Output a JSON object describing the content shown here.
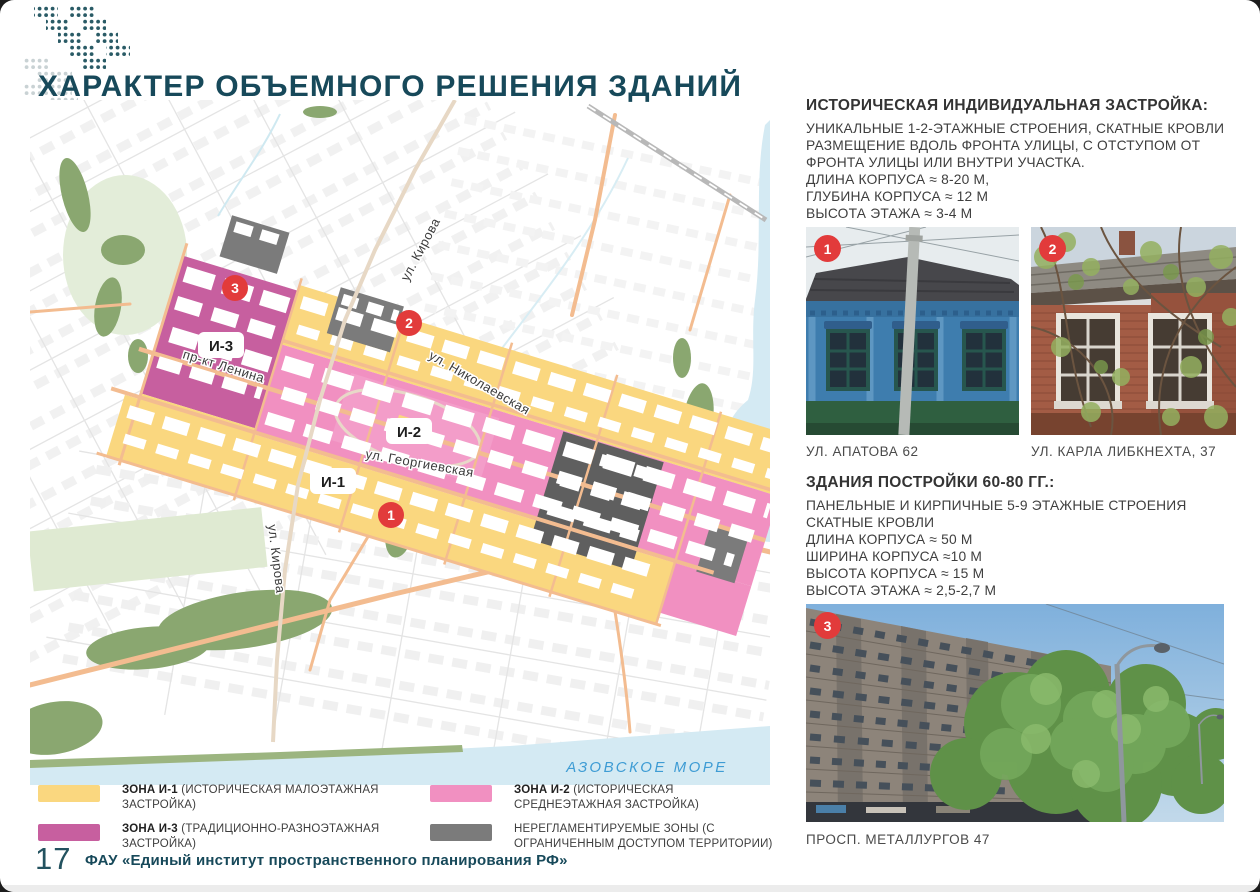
{
  "page": {
    "title": "ХАРАКТЕР ОБЪЕМНОГО РЕШЕНИЯ ЗДАНИЙ",
    "page_number": "17",
    "footer": "ФАУ «Единый институт пространственного планирования РФ»"
  },
  "colors": {
    "accent_teal": "#17495A",
    "zone_i1_yellow": "#FAD77F",
    "zone_i2_pink": "#F190C1",
    "zone_i3_magenta": "#C75F9F",
    "zone_gray": "#7B7B7B",
    "marker_red": "#E23B3B",
    "water": "#D4EAF3",
    "park_green": "#8AA770",
    "road_orange": "#F3BC90"
  },
  "map": {
    "sea_label": "АЗОВСКОЕ МОРЕ",
    "streets": [
      {
        "name": "ул. Кирова"
      },
      {
        "name": "ул. Николаевская"
      },
      {
        "name": "пр-кт Ленина"
      },
      {
        "name": "ул. Георгиевская"
      },
      {
        "name": "ул. Кирова"
      }
    ],
    "zones": [
      {
        "label": "И-3"
      },
      {
        "label": "И-2"
      },
      {
        "label": "И-1"
      }
    ],
    "markers": [
      {
        "number": "1"
      },
      {
        "number": "2"
      },
      {
        "number": "3"
      }
    ]
  },
  "sections": [
    {
      "heading": "ИСТОРИЧЕСКАЯ ИНДИВИДУАЛЬНАЯ ЗАСТРОЙКА:",
      "lines": [
        "УНИКАЛЬНЫЕ 1-2-ЭТАЖНЫЕ СТРОЕНИЯ, СКАТНЫЕ КРОВЛИ",
        "РАЗМЕЩЕНИЕ ВДОЛЬ ФРОНТА УЛИЦЫ, С ОТСТУПОМ ОТ",
        "ФРОНТА УЛИЦЫ ИЛИ ВНУТРИ УЧАСТКА.",
        "ДЛИНА КОРПУСА ≈ 8-20 М,",
        "ГЛУБИНА КОРПУСА ≈ 12 М",
        "ВЫСОТА ЭТАЖА ≈ 3-4 М"
      ],
      "photos": [
        {
          "badge": "1",
          "caption": "УЛ. АПАТОВА 62"
        },
        {
          "badge": "2",
          "caption": "УЛ. КАРЛА ЛИБКНЕХТА, 37"
        }
      ]
    },
    {
      "heading": "ЗДАНИЯ ПОСТРОЙКИ 60-80 ГГ.:",
      "lines": [
        "ПАНЕЛЬНЫЕ И КИРПИЧНЫЕ 5-9 ЭТАЖНЫЕ СТРОЕНИЯ",
        "СКАТНЫЕ КРОВЛИ",
        "ДЛИНА КОРПУСА ≈ 50 М",
        "ШИРИНА КОРПУСА ≈10 М",
        "ВЫСОТА КОРПУСА ≈ 15 М",
        "ВЫСОТА ЭТАЖА ≈ 2,5-2,7 М"
      ],
      "photos": [
        {
          "badge": "3",
          "caption": "ПРОСП. МЕТАЛЛУРГОВ 47"
        }
      ]
    }
  ],
  "legend": {
    "items": [
      {
        "swatch": "#FAD77F",
        "bold": "ЗОНА И-1",
        "rest": " (ИСТОРИЧЕСКАЯ МАЛОЭТАЖНАЯ ЗАСТРОЙКА)"
      },
      {
        "swatch": "#F190C1",
        "bold": "ЗОНА И-2",
        "rest": " (ИСТОРИЧЕСКАЯ СРЕДНЕЭТАЖНАЯ ЗАСТРОЙКА)"
      },
      {
        "swatch": "#C75F9F",
        "bold": "ЗОНА И-3",
        "rest": " (ТРАДИЦИОННО-РАЗНОЭТАЖНАЯ ЗАСТРОЙКА)"
      },
      {
        "swatch": "#7B7B7B",
        "bold": "",
        "rest": "НЕРЕГЛАМЕНТИРУЕМЫЕ ЗОНЫ (С ОГРАНИЧЕННЫМ ДОСТУПОМ ТЕРРИТОРИИ)"
      }
    ]
  }
}
